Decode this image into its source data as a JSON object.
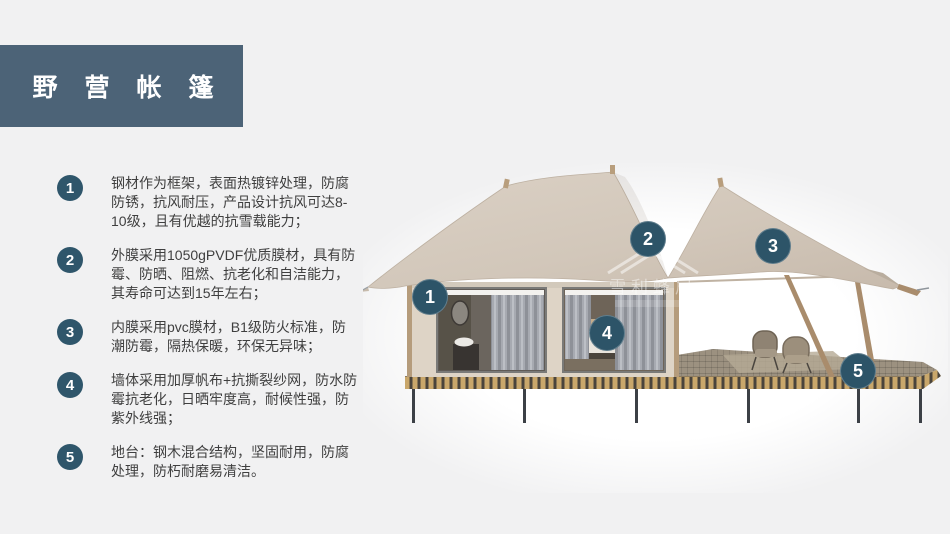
{
  "slide": {
    "title": "野营帐篷"
  },
  "features": [
    {
      "num": "1",
      "text": "钢材作为框架，表面热镀锌处理，防腐防锈，抗风耐压，产品设计抗风可达8-10级，且有优越的抗雪载能力；"
    },
    {
      "num": "2",
      "text": "外膜采用1050gPVDF优质膜材，具有防霉、防晒、阻燃、抗老化和自洁能力，其寿命可达到15年左右；"
    },
    {
      "num": "3",
      "text": "内膜采用pvc膜材，B1级防火标准，防潮防霉，隔热保暖，环保无异味；"
    },
    {
      "num": "4",
      "text": "墙体采用加厚帆布+抗撕裂纱网，防水防霉抗老化，日晒牢度高，耐候性强，防紫外线强；"
    },
    {
      "num": "5",
      "text": "地台：钢木混合结构，坚固耐用，防腐处理，防朽耐磨易清洁。"
    }
  ],
  "callouts": [
    {
      "num": "1"
    },
    {
      "num": "2"
    },
    {
      "num": "3"
    },
    {
      "num": "4"
    },
    {
      "num": "5"
    }
  ],
  "watermark": {
    "text": "雪利蜂居"
  },
  "colors": {
    "accent_badge": "#2d5468",
    "title_bg": "#4c6377",
    "slide_bg": "#f1f1f2",
    "body_text": "#3f3f3f",
    "roof_fabric": "#d3c8bb",
    "cabin_wall": "#ded4c6",
    "wood_frame": "#b2987a",
    "deck_stripe": "#c9a76b",
    "steel_leg": "#3c4046"
  }
}
